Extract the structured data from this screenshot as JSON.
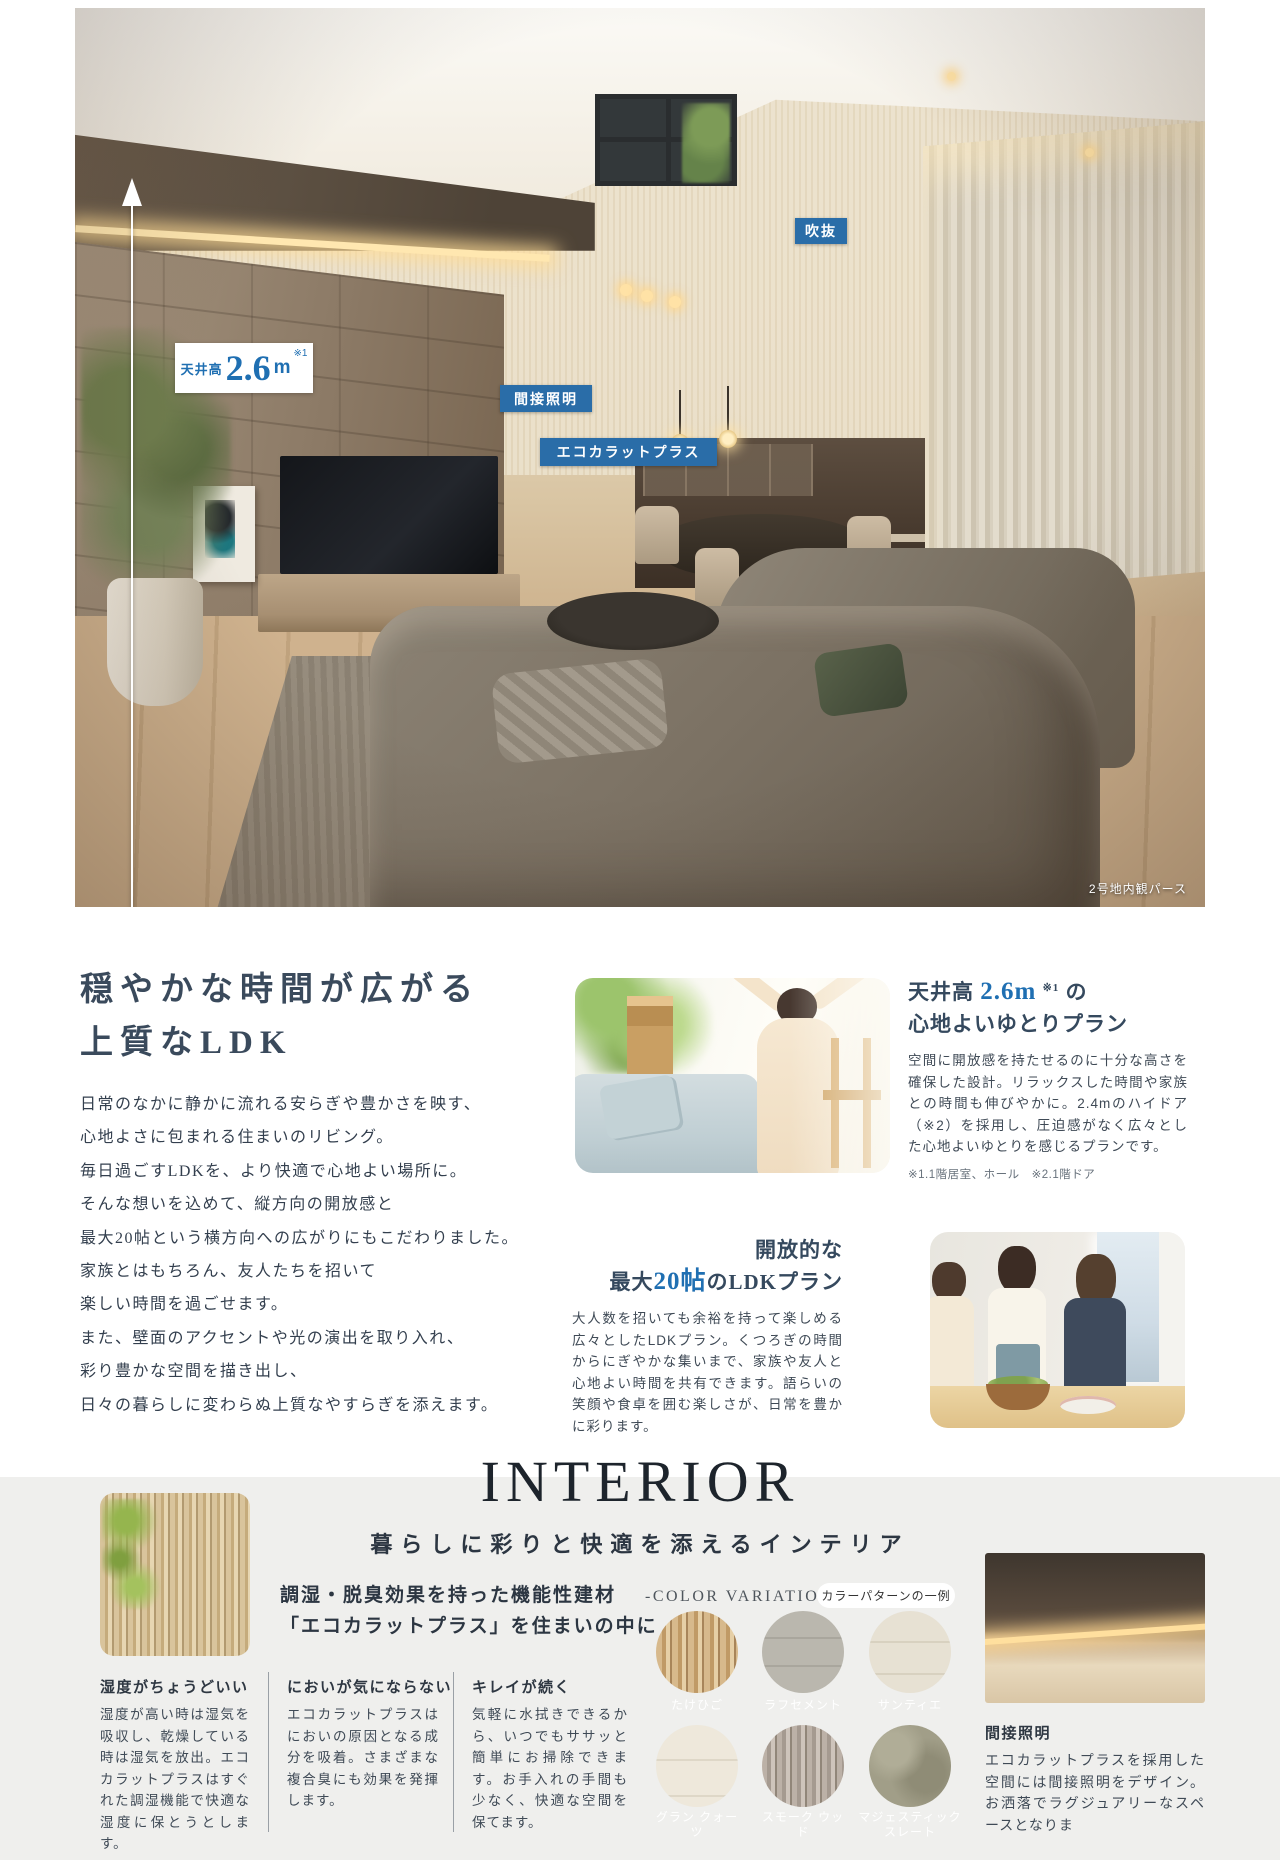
{
  "accent_blue": "#2a6da8",
  "hero": {
    "badges": {
      "void": "吹抜",
      "indirect_lighting": "間接照明",
      "ecocarat": "エコカラットプラス"
    },
    "ceiling_badge": {
      "prefix": "天井高",
      "value": "2.6",
      "unit": "m",
      "note": "※1"
    },
    "caption": "2号地内観パース"
  },
  "main": {
    "title_line1": "穏やかな時間が広がる",
    "title_line2": "上質なLDK",
    "paragraph_lines": [
      "日常のなかに静かに流れる安らぎや豊かさを映す、",
      "心地よさに包まれる住まいのリビング。",
      "毎日過ごすLDKを、より快適で心地よい場所に。",
      "そんな想いを込めて、縦方向の開放感と",
      "最大20帖という横方向への広がりにもこだわりました。",
      "家族とはもちろん、友人たちを招いて",
      "楽しい時間を過ごせます。",
      "また、壁面のアクセントや光の演出を取り入れ、",
      "彩り豊かな空間を描き出し、",
      "日々の暮らしに変わらぬ上質なやすらぎを添えます。"
    ]
  },
  "plan1": {
    "heading_pre": "天井高",
    "heading_value": "2.6m",
    "heading_note": "※1",
    "heading_post": "の",
    "heading_line2": "心地よいゆとりプラン",
    "body": "空間に開放感を持たせるのに十分な高さを確保した設計。リラックスした時間や家族との時間も伸びやかに。2.4mのハイドア（※2）を採用し、圧迫感がなく広々とした心地よいゆとりを感じるプランです。",
    "note": "※1.1階居室、ホール　※2.1階ドア"
  },
  "plan2": {
    "heading_line1": "開放的な",
    "heading_pre": "最大",
    "heading_value": "20帖",
    "heading_post": "のLDKプラン",
    "body": "大人数を招いても余裕を持って楽しめる広々としたLDKプラン。くつろぎの時間からにぎやかな集いまで、家族や友人と心地よい時間を共有できます。語らいの笑顔や食卓を囲む楽しさが、日常を豊かに彩ります。"
  },
  "interior": {
    "title": "INTERIOR",
    "subtitle": "暮らしに彩りと快適を添えるインテリア",
    "lead_line1": "調湿・脱臭効果を持った機能性建材",
    "lead_line2": "「エコカラットプラス」を住まいの中に",
    "features": [
      {
        "heading": "湿度がちょうどいい",
        "body": "湿度が高い時は湿気を吸収し、乾燥している時は湿気を放出。エコカラットプラスはすぐれた調湿機能で快適な湿度に保とうとします。"
      },
      {
        "heading": "においが気にならない",
        "body": "エコカラットプラスはにおいの原因となる成分を吸着。さまざまな複合臭にも効果を発揮します。"
      },
      {
        "heading": "キレイが続く",
        "body": "気軽に水拭きできるから、いつでもササッと簡単にお掃除できます。お手入れの手間も少なく、快適な空間を保てます。"
      }
    ],
    "color_variations_label": "-COLOR VARIATIONS-",
    "color_variations_badge": "カラーパターンの一例",
    "swatches": [
      {
        "name": "たけひご"
      },
      {
        "name": "ラフセメント"
      },
      {
        "name": "サンティエ"
      },
      {
        "name": "グラン クォーツ"
      },
      {
        "name": "スモーク ウッド"
      },
      {
        "name": "マジェスティック スレート"
      }
    ],
    "lighting": {
      "heading": "間接照明",
      "body": "エコカラットプラスを採用した空間には間接照明をデザイン。お洒落でラグジュアリーなスペースとなりま"
    }
  }
}
